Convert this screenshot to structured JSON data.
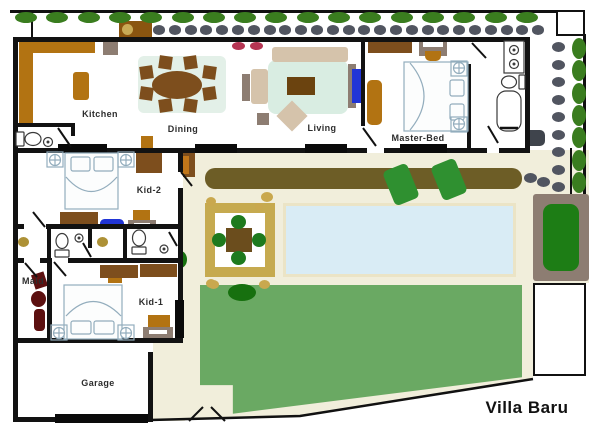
{
  "title": "Villa Baru",
  "rooms": {
    "kitchen": "Kitchen",
    "dining": "Dining",
    "living": "Living",
    "master": "Master-Bed",
    "kid2": "Kid-2",
    "kid1": "Kid-1",
    "maid": "Maid",
    "garage": "Garage"
  },
  "bed_caption": {
    "line1": "BED ROOM",
    "line2": "FL 9.90"
  },
  "landscape": {
    "top_hedge_shrubs": 17,
    "right_hedge_shrubs": 7,
    "top_stepping_stones": 25,
    "right_stepping_stones": 9
  },
  "palette": {
    "hedge": "#3a7d1f",
    "stone": "#515560",
    "lawn": "#6aa963",
    "pool": "#d9ecf5",
    "cream": "#f1eedb",
    "wood": "#b27312",
    "wood_dark": "#7d4e1d",
    "pergola": "#c6aa4f",
    "dark_green": "#17700f",
    "maroon": "#5c1010",
    "accent_blue": "#2135d6"
  }
}
